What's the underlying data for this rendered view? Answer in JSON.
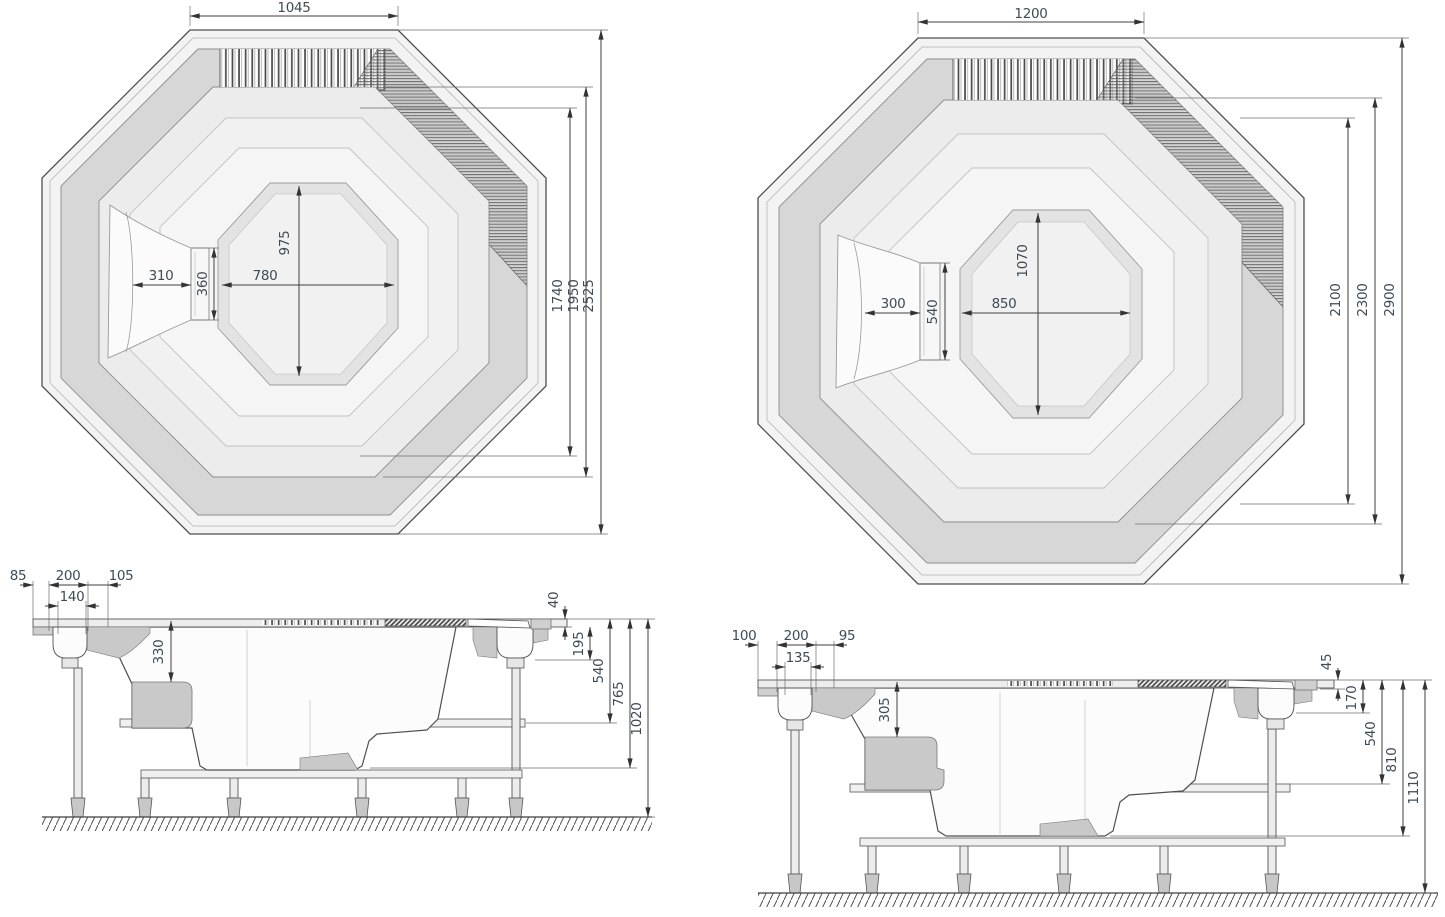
{
  "plan_a": {
    "top_width": "1045",
    "floor_length": "975",
    "floor_width": "780",
    "footwell_width": "310",
    "step_width": "360",
    "width_inner": "1740",
    "width_mid": "1950",
    "width_overall": "2525"
  },
  "plan_b": {
    "top_width": "1200",
    "floor_length": "1070",
    "floor_width": "850",
    "footwell_width": "300",
    "step_width": "540",
    "width_inner": "2100",
    "width_mid": "2300",
    "width_overall": "2900"
  },
  "side_a": {
    "rim_overhang": "85",
    "skimmer_box": "200",
    "rim_gap": "105",
    "skimmer_inner": "140",
    "seat_depth": "330",
    "lip_height": "40",
    "rim_height": "195",
    "frame_height": "540",
    "shell_depth": "765",
    "overall_height": "1020"
  },
  "side_b": {
    "rim_overhang": "100",
    "skimmer_box": "200",
    "rim_gap": "95",
    "skimmer_inner": "135",
    "seat_depth": "305",
    "lip_height": "45",
    "rim_height": "170",
    "frame_height": "540",
    "shell_depth": "810",
    "overall_height": "1110"
  },
  "colors": {
    "outline": "#4d4d4d",
    "band_dark": "#d7d7d7",
    "seat_dark": "#c9c9c9",
    "shell_light": "#f3f3f3",
    "dim_text": "#3d4b57"
  }
}
